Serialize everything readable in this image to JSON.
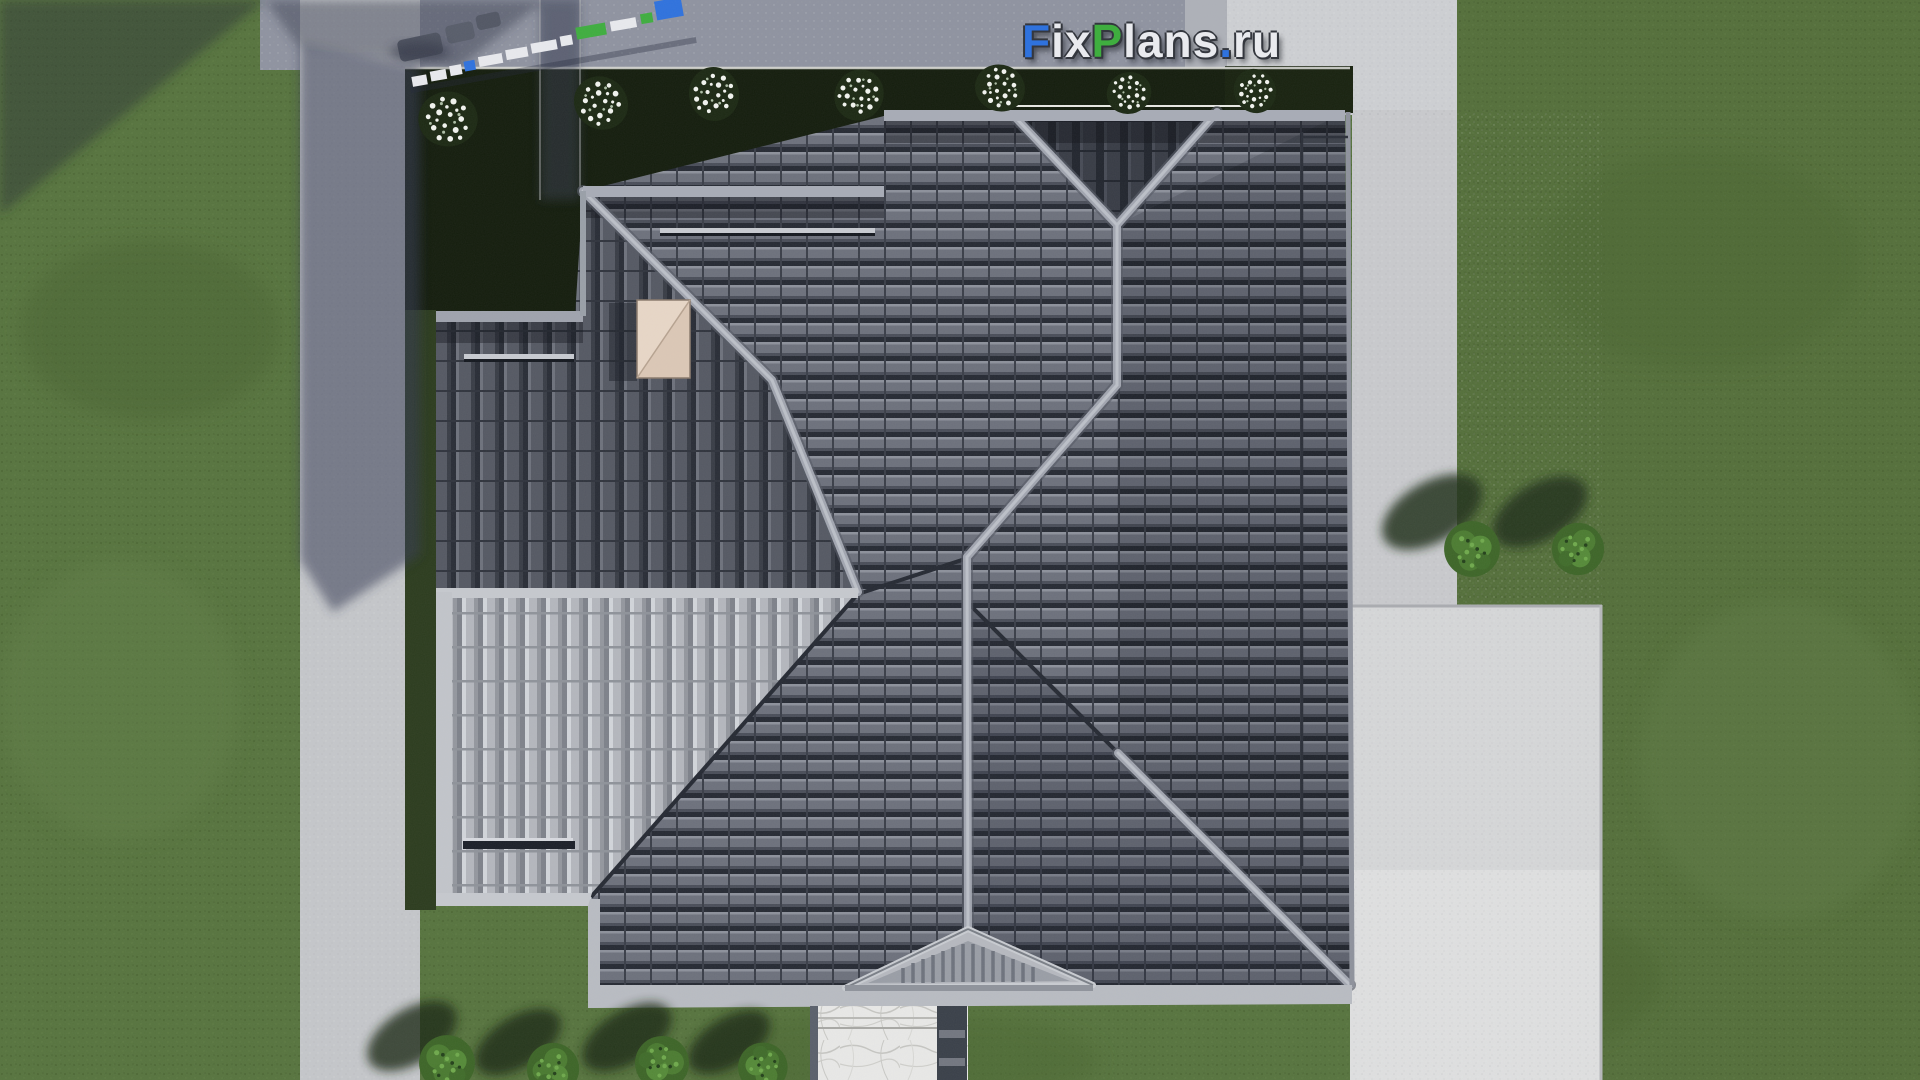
{
  "watermark": {
    "text": "FixPlans.ru",
    "letters": [
      {
        "ch": "F",
        "color": "#2f72dd"
      },
      {
        "ch": "i",
        "color": "#e9eaee"
      },
      {
        "ch": "x",
        "color": "#e9eaee"
      },
      {
        "ch": "P",
        "color": "#3fae3f"
      },
      {
        "ch": "l",
        "color": "#e9eaee"
      },
      {
        "ch": "a",
        "color": "#e9eaee"
      },
      {
        "ch": "n",
        "color": "#e9eaee"
      },
      {
        "ch": "s",
        "color": "#e9eaee"
      },
      {
        "ch": ".",
        "color": "#2f72dd"
      },
      {
        "ch": "r",
        "color": "#e9eaee"
      },
      {
        "ch": "u",
        "color": "#e9eaee"
      }
    ]
  },
  "scene": {
    "description": "Top-down 3D render of a house hip roof with dark tiles, light terrace roof, chimney, entrance gable, lawns, concrete pavements, flowering shrubs and trees",
    "palette": {
      "accent_blue": "#2f72dd",
      "accent_green": "#3fae3f",
      "letter_white": "#e9eaee",
      "lawn": "#57743e",
      "lawn_right": "#546f3a",
      "planting_bed": "#141d0d",
      "street": "#8f93a0",
      "shadow": "#353c52",
      "pavement_strip": "#c9cacd",
      "pavement_pad": "#d6d7d8",
      "roof_main": "#6d717c",
      "roof_east": "#5e626d",
      "roof_shaded": "#3a3e48",
      "roof_west": "#555963",
      "roof_light": "#b4b7bd",
      "ridge_cap": "#a2a6b0",
      "fascia": "#b9bcc2",
      "chimney": "#dcc8b6",
      "walkway": "#e9e9e7",
      "walkway_stripe": "#3a4049",
      "bush": "#4a7a30"
    }
  }
}
